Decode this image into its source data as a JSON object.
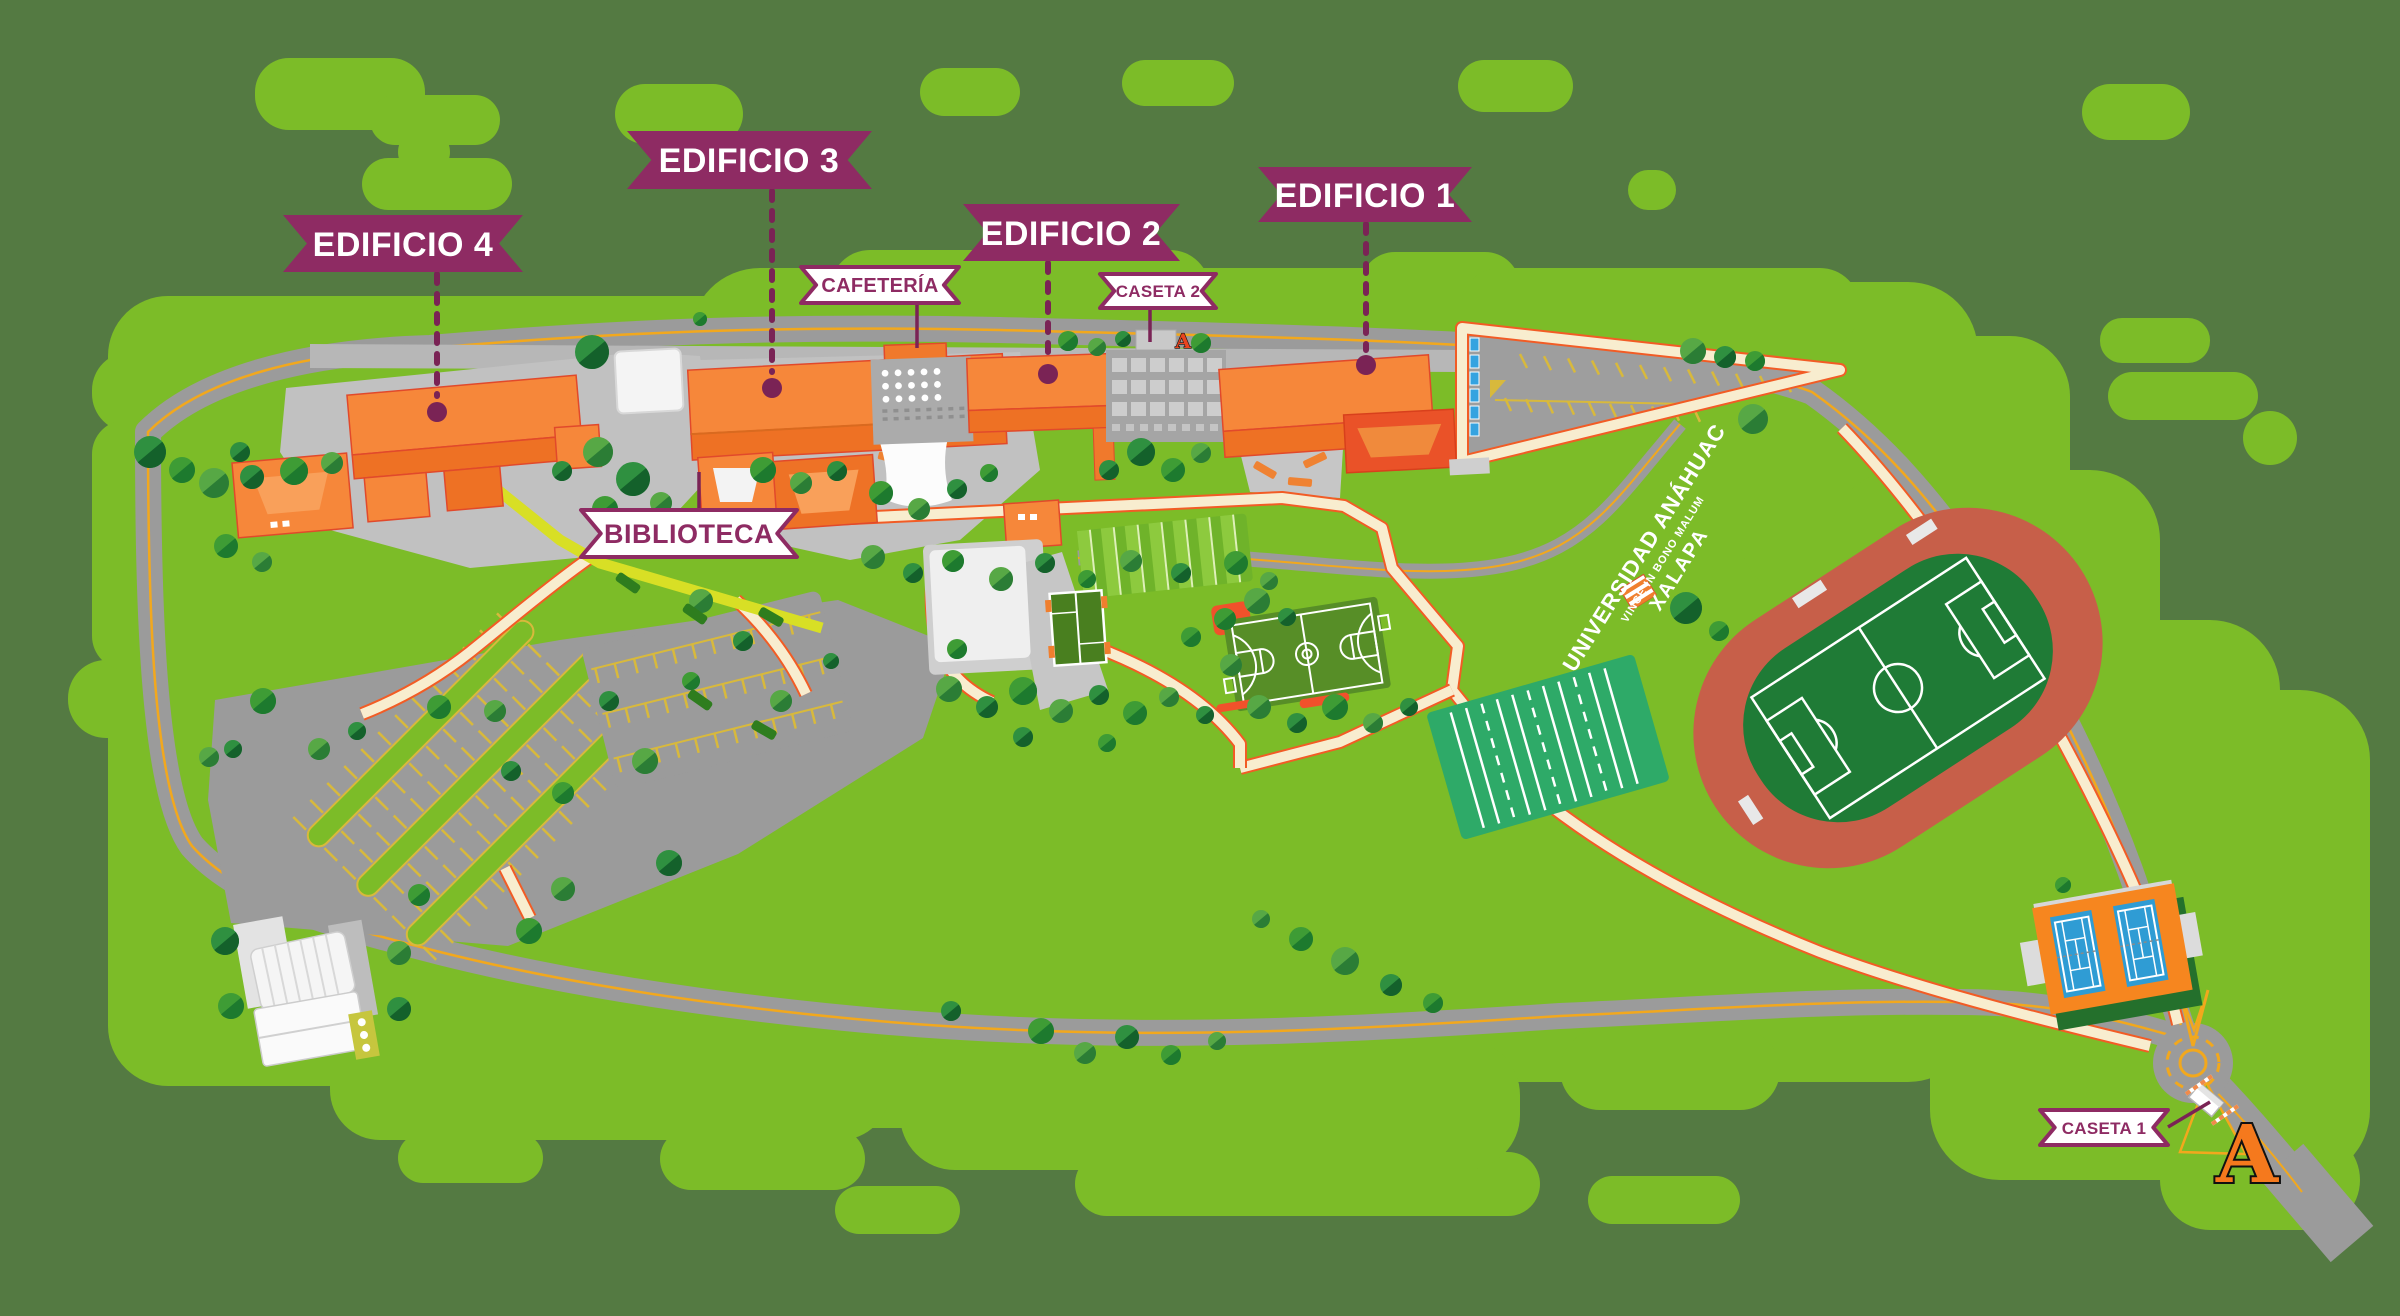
{
  "labels": {
    "edificio_1": "EDIFICIO 1",
    "edificio_2": "EDIFICIO 2",
    "edificio_3": "EDIFICIO 3",
    "edificio_4": "EDIFICIO 4",
    "cafeteria": "CAFETERÍA",
    "biblioteca": "BIBLIOTECA",
    "caseta_1": "CASETA 1",
    "caseta_2": "CASETA 2"
  },
  "watermark": {
    "line1": "UNIVERSIDAD ANÁHUAC",
    "line2": "VINCE IN BONO MALUM",
    "line3": "XALAPA"
  },
  "logo_letter": "A",
  "colors": {
    "background": "#547a42",
    "meadow": "#7cbc28",
    "road_gray": "#9b9b9b",
    "road_line_yellow": "#f2a81d",
    "path_cream": "#f8edcf",
    "path_edge_orange": "#f25c25",
    "building_orange": "#f6873a",
    "building_orange_dark": "#ee7124",
    "building_outline": "#e1492b",
    "plaza_gray": "#c1c1c1",
    "banner_purple": "#8e2b63",
    "pointer_purple": "#7a2355",
    "track_red": "#c75f49",
    "field_green": "#1f7b36",
    "practice_green": "#2eaa68",
    "court_blue": "#2f9cd4",
    "tennis_orange": "#f6861f",
    "basket_green": "#578e27",
    "tree_dark": "#14612b",
    "tree_light": "#2f9040",
    "lime_path": "#d8df25",
    "parking_stripe": "#d8b93c",
    "accessible_blue": "#35a3e0",
    "logo_orange": "#f5791d"
  }
}
